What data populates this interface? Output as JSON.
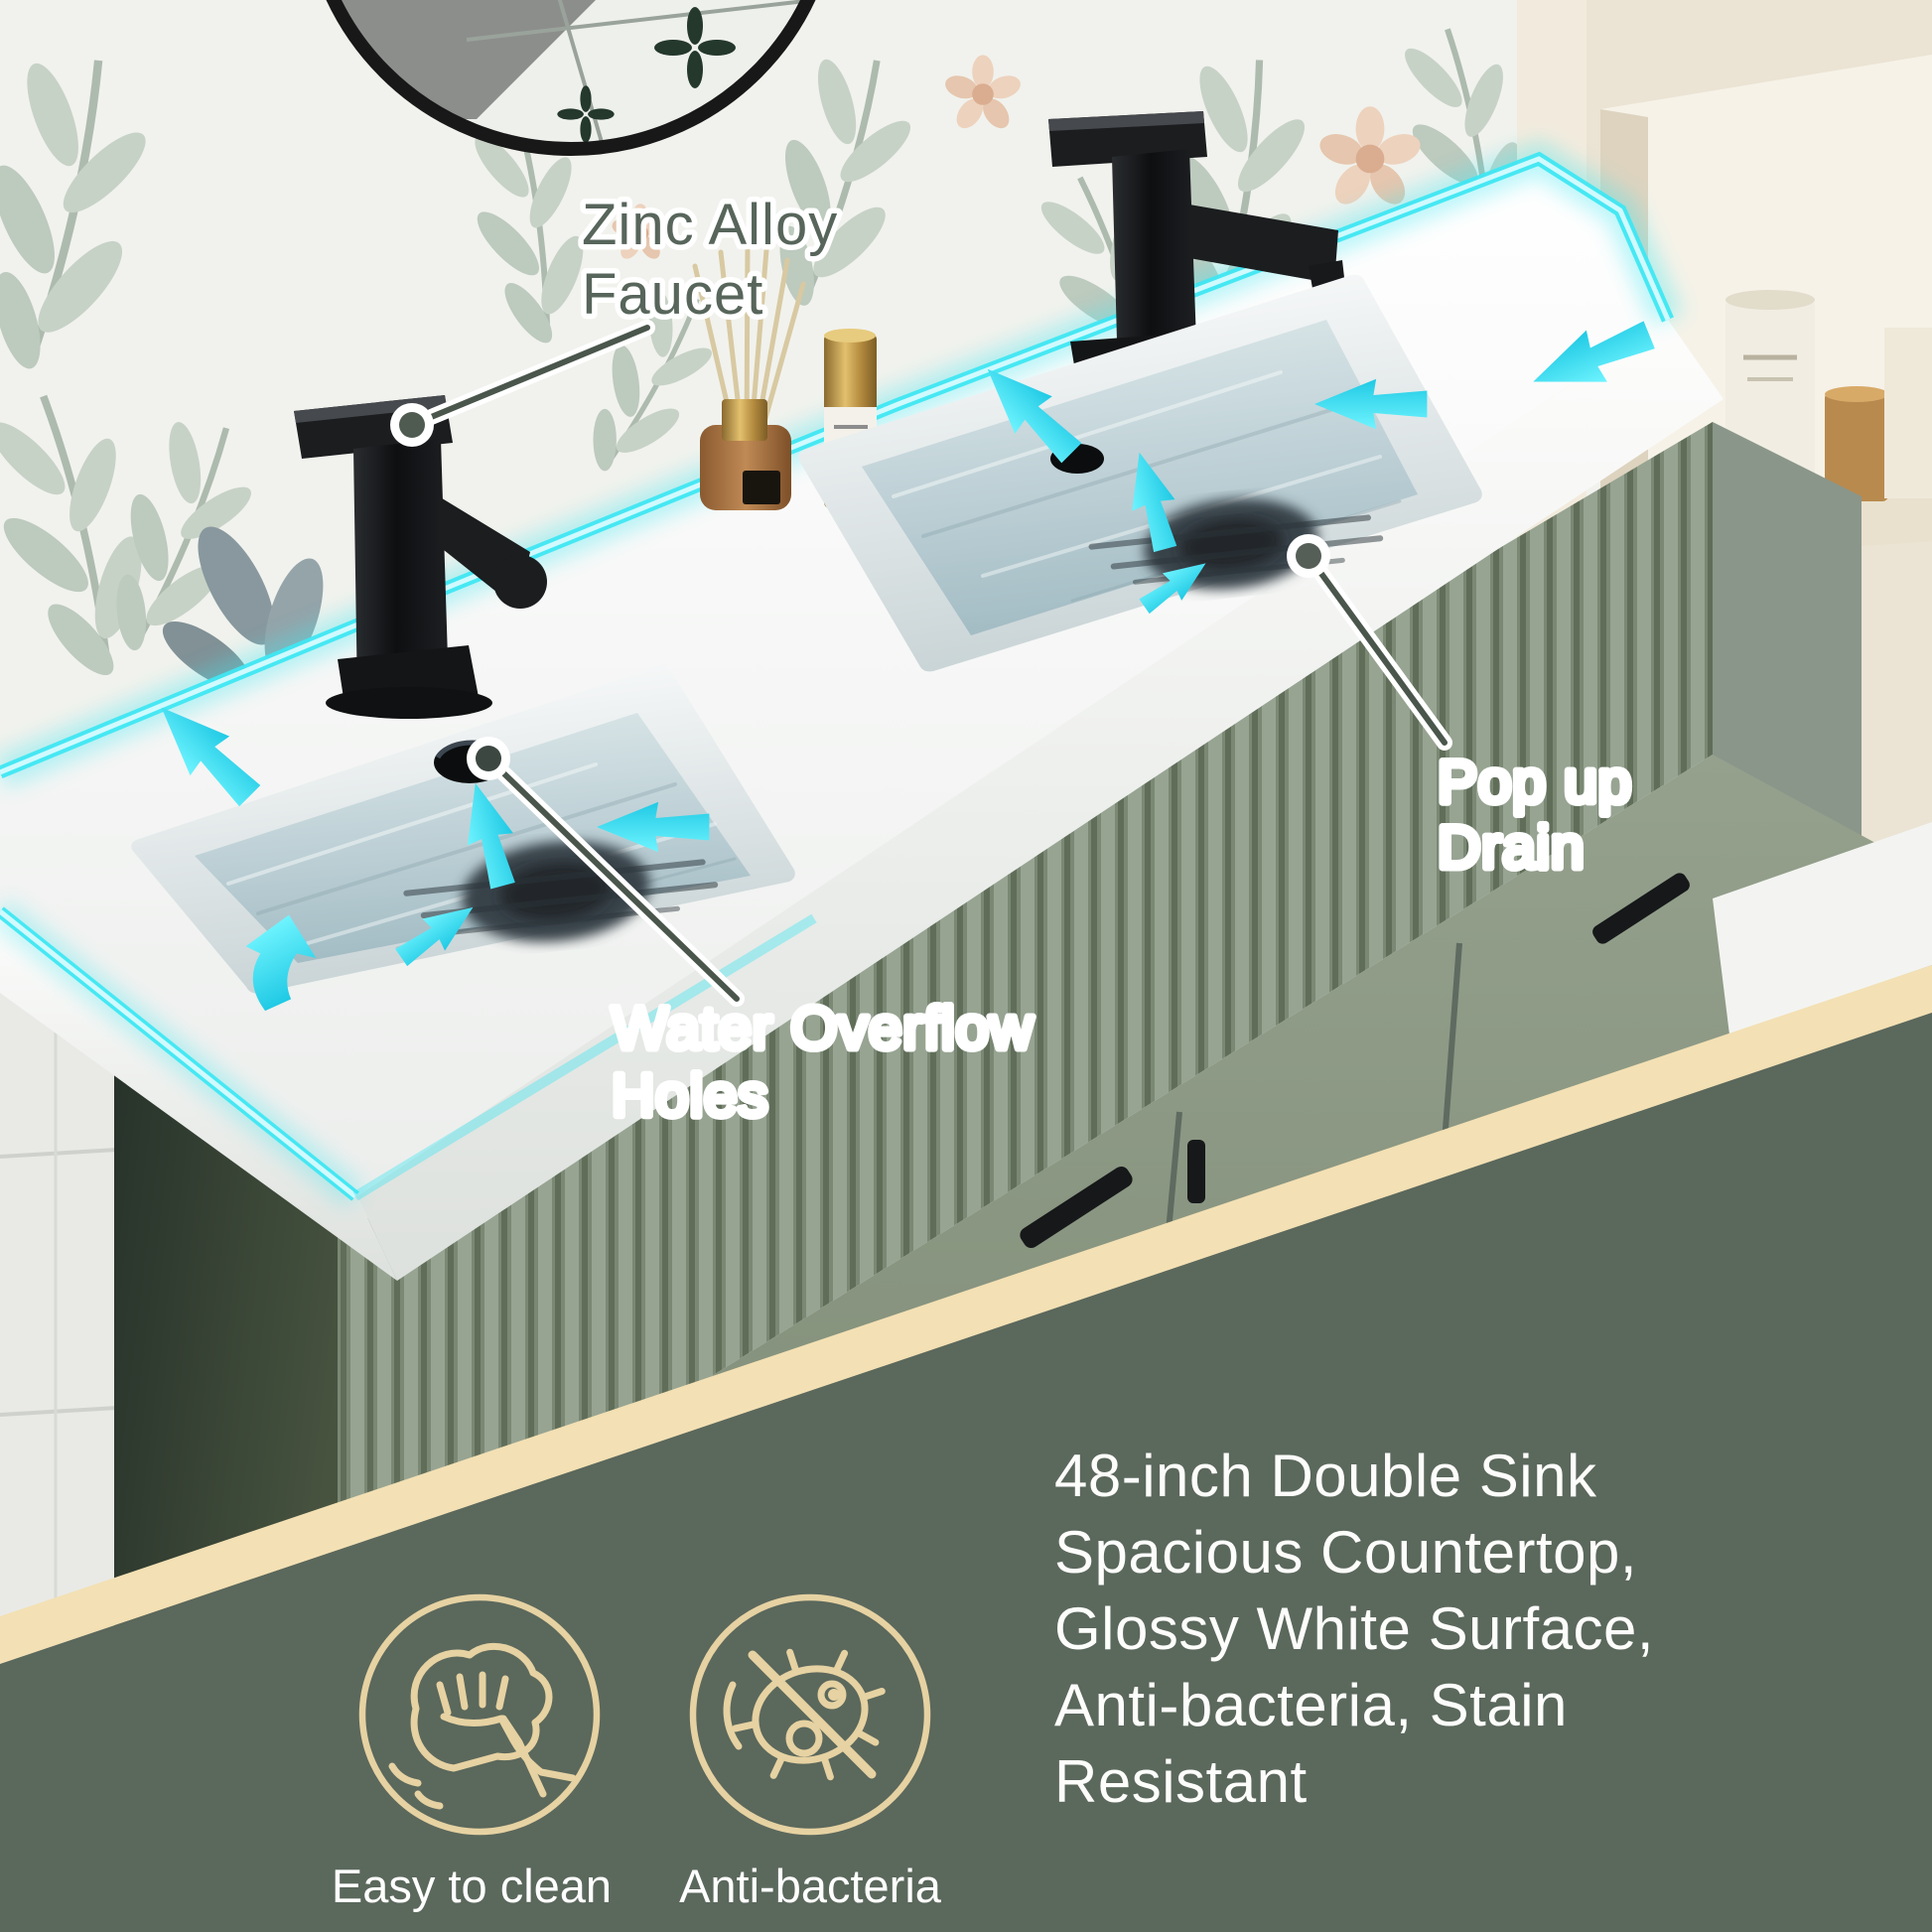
{
  "callouts": {
    "faucet": {
      "line1": "Zinc Alloy",
      "line2": "Faucet"
    },
    "drain": {
      "line1": "Pop up",
      "line2": "Drain"
    },
    "overflow": {
      "line1": "Water Overflow",
      "line2": "Holes"
    }
  },
  "features": {
    "description_lines": [
      "48-inch Double Sink",
      "Spacious Countertop,",
      "Glossy White Surface,",
      "Anti-bacteria, Stain",
      "Resistant"
    ],
    "badges": [
      {
        "icon": "wipe-hand-icon",
        "label": "Easy to clean"
      },
      {
        "icon": "no-bacteria-icon",
        "label": "Anti-bacteria"
      }
    ]
  },
  "colors": {
    "led_accent_cyan": "#3fe7f2",
    "band_beige": "#f3e0b4",
    "bottom_panel_green": "#5b685c",
    "icon_outline_tan": "#e6d2a2",
    "label_text_green": "#57655b",
    "vanity_sage": "#8c998c",
    "countertop_white": "#f7f8f6"
  }
}
